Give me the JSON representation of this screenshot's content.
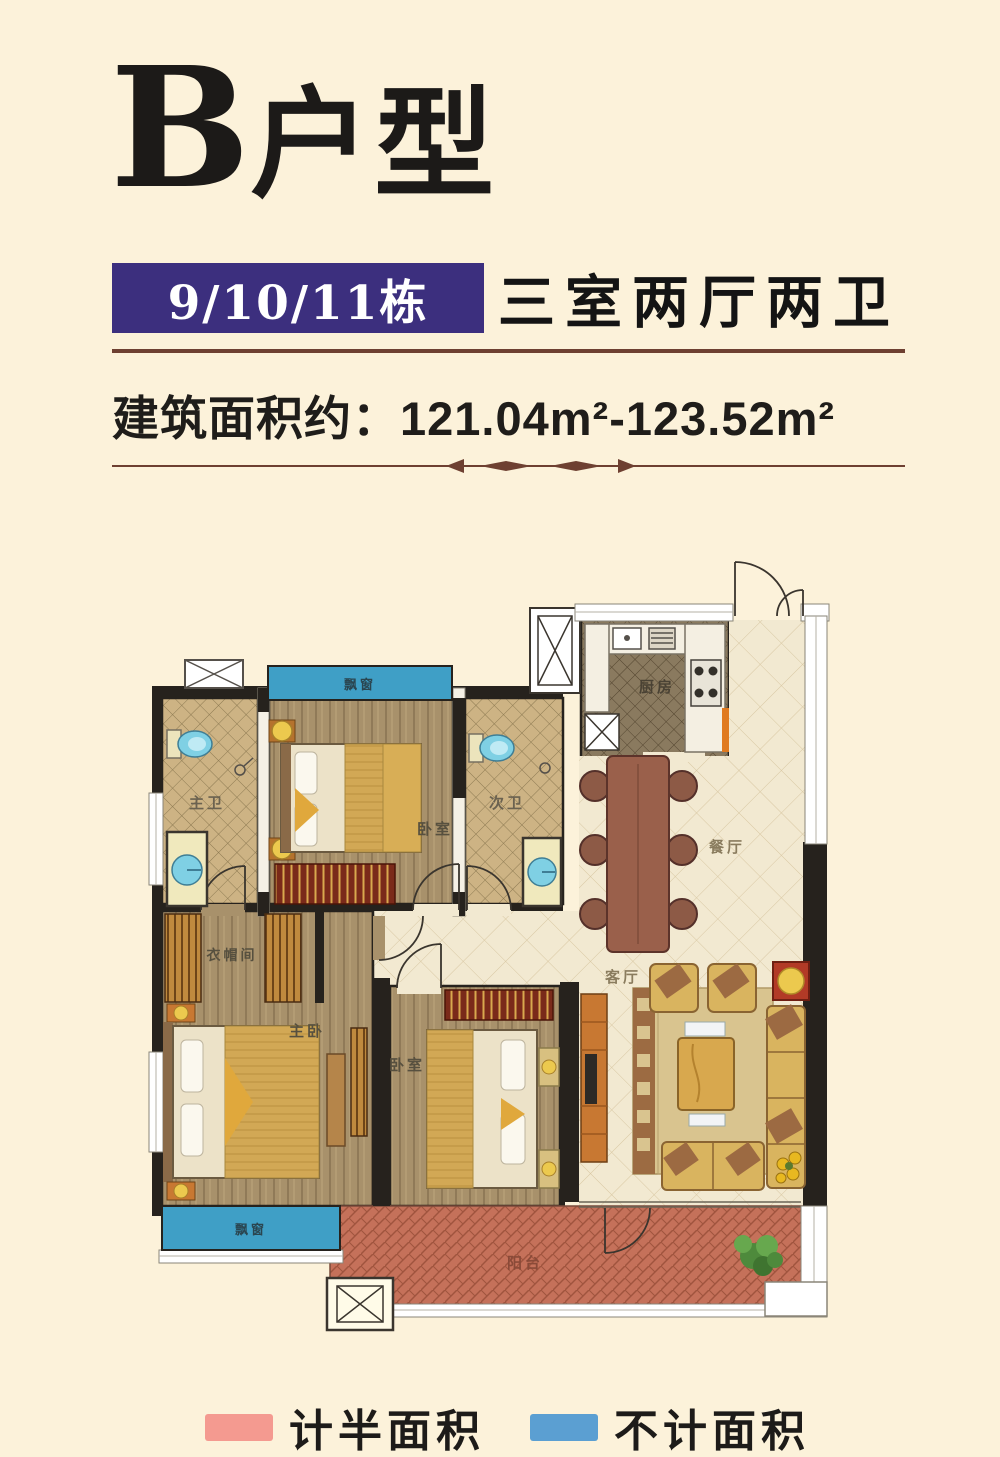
{
  "page": {
    "title_prefix": "B",
    "title_suffix": "户型",
    "banner": {
      "buildings": "9/10/11栋",
      "layout": "三室两厅两卫"
    },
    "area_text": "建筑面积约：121.04m²-123.52m²"
  },
  "floorplan": {
    "rooms": {
      "bay_window_top": "飘窗",
      "master_bath": "主卫",
      "bedroom_top": "卧室",
      "second_bath": "次卫",
      "kitchen": "厨房",
      "dining": "餐厅",
      "living": "客厅",
      "closet": "衣帽间",
      "master_bedroom": "主卧",
      "bedroom_bottom": "卧室",
      "bay_window_bottom": "飘窗",
      "balcony": "阳台"
    },
    "colors": {
      "wall": "#26221d",
      "bay_window_blue": "#3f9fc6",
      "balcony_red": "#c5715a",
      "wood_floor": "#a8916b",
      "bath_tile": "#cdb384",
      "hall_tile": "#f2e9d1",
      "kitchen_tile": "#8a7a5f"
    }
  },
  "legend": {
    "items": [
      {
        "label": "计半面积",
        "color": "#f49a90"
      },
      {
        "label": "不计面积",
        "color": "#5b9fd2"
      }
    ]
  }
}
